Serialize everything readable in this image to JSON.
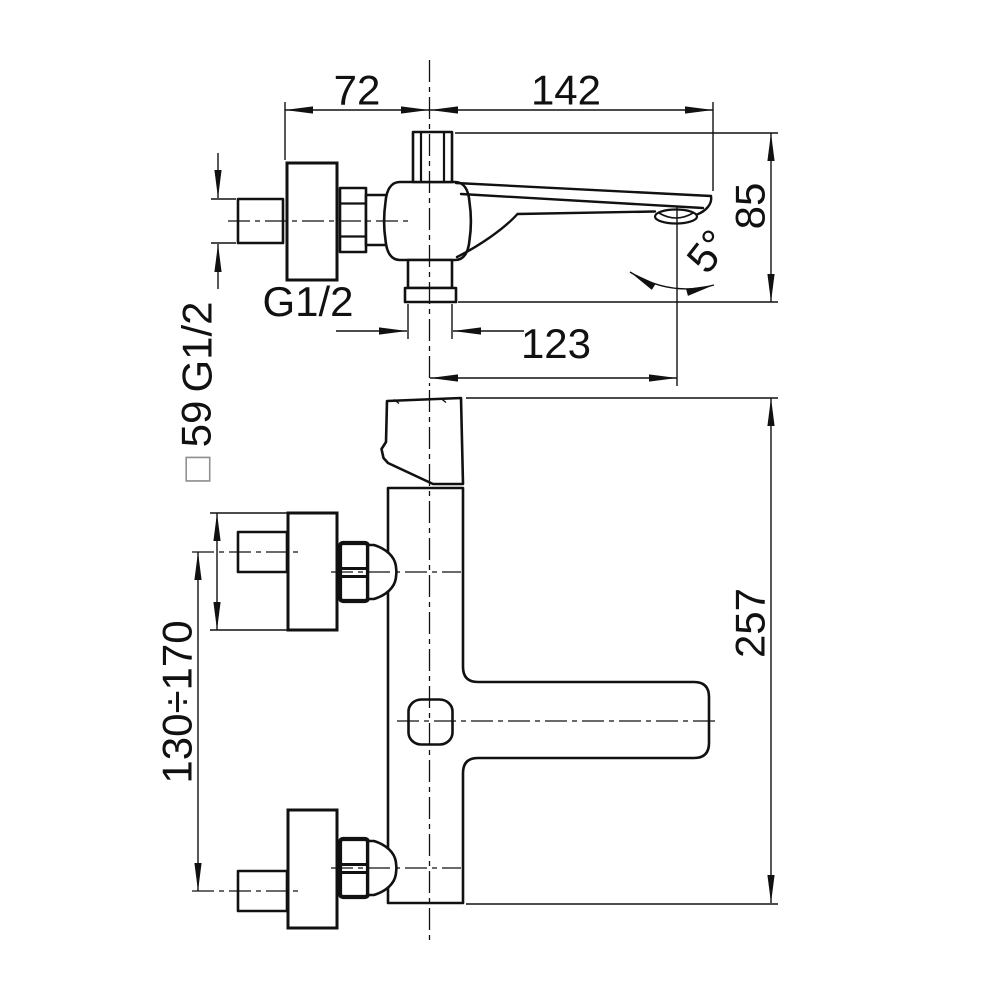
{
  "drawing": {
    "top_view": {
      "wall_offset": "72",
      "spout_reach": "142",
      "spout_height": "85",
      "spout_angle": "5°",
      "inlet_thread": "G1/2",
      "outlet_thread": "G1/2",
      "outlet_reach": "123"
    },
    "side_view": {
      "plate_square_symbol": "□",
      "plate_size": "59",
      "inlet_spacing": "130÷170",
      "overall_height": "257"
    }
  }
}
